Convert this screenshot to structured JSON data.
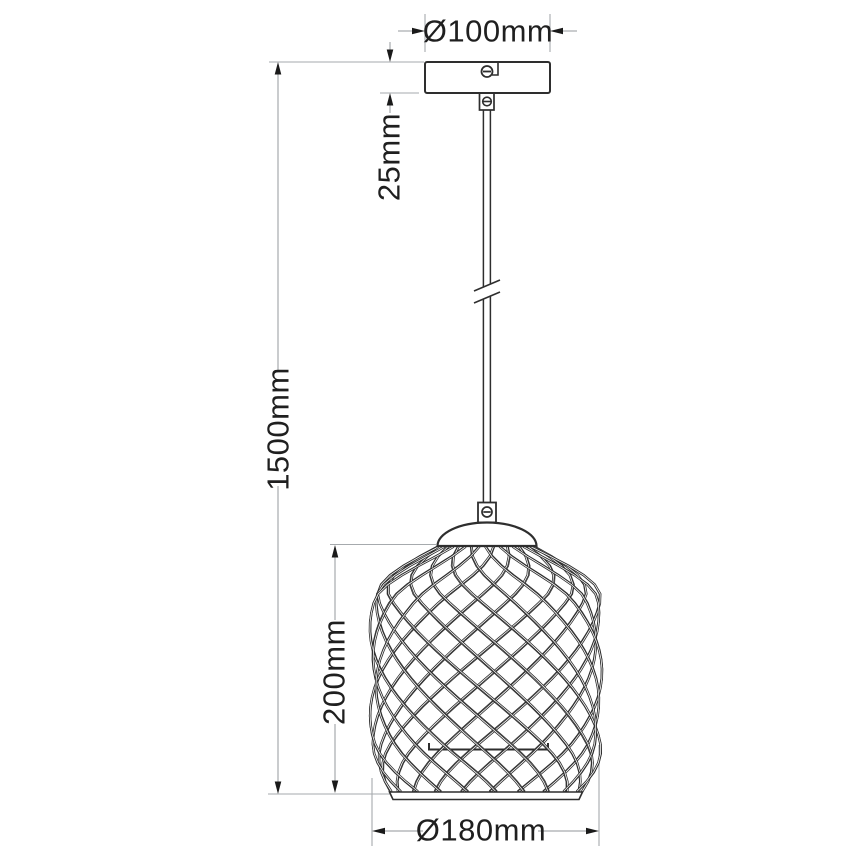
{
  "drawing": {
    "type": "pendant-lamp-dimension-diagram",
    "unit": "mm",
    "labels": {
      "canopy_diameter": "Ø100mm",
      "canopy_height": "25mm",
      "total_height": "1500mm",
      "shade_height": "200mm",
      "shade_diameter": "Ø180mm"
    },
    "values": {
      "canopy_diameter_mm": 100,
      "canopy_height_mm": 25,
      "total_height_mm": 1500,
      "shade_height_mm": 200,
      "shade_diameter_mm": 180
    },
    "colors": {
      "object_line": "#2e2e2e",
      "dimension_line": "#a6aaad",
      "text": "#1f1f1f",
      "background": "#ffffff"
    }
  }
}
